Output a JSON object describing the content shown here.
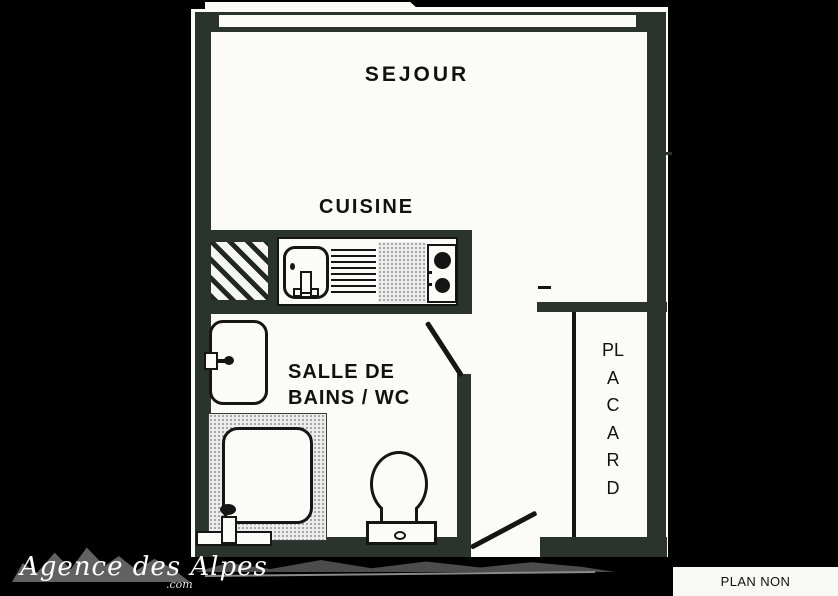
{
  "title": "Studio apartment floor plan",
  "rooms": {
    "sejour": {
      "label": "SEJOUR"
    },
    "cuisine": {
      "label": "CUISINE"
    },
    "bathroom": {
      "label_line1": "SALLE DE",
      "label_line2": "BAINS / WC"
    },
    "placard": {
      "label": "PLACARD"
    }
  },
  "fixtures": [
    "window",
    "hatched-area",
    "kitchen-sink",
    "drainer",
    "worktop",
    "cooktop",
    "washbasin",
    "shower-tray",
    "toilet",
    "bathroom-door",
    "entry-door",
    "closet-front"
  ],
  "watermark": {
    "brand": "Agence des Alpes",
    "domain_suffix": ".com"
  },
  "footer": {
    "disclaimer": "PLAN NON CONTRACTUEL"
  },
  "colors": {
    "background": "#000000",
    "paper": "#fbfbf8",
    "wall": "#2a342c",
    "line": "#151515"
  }
}
